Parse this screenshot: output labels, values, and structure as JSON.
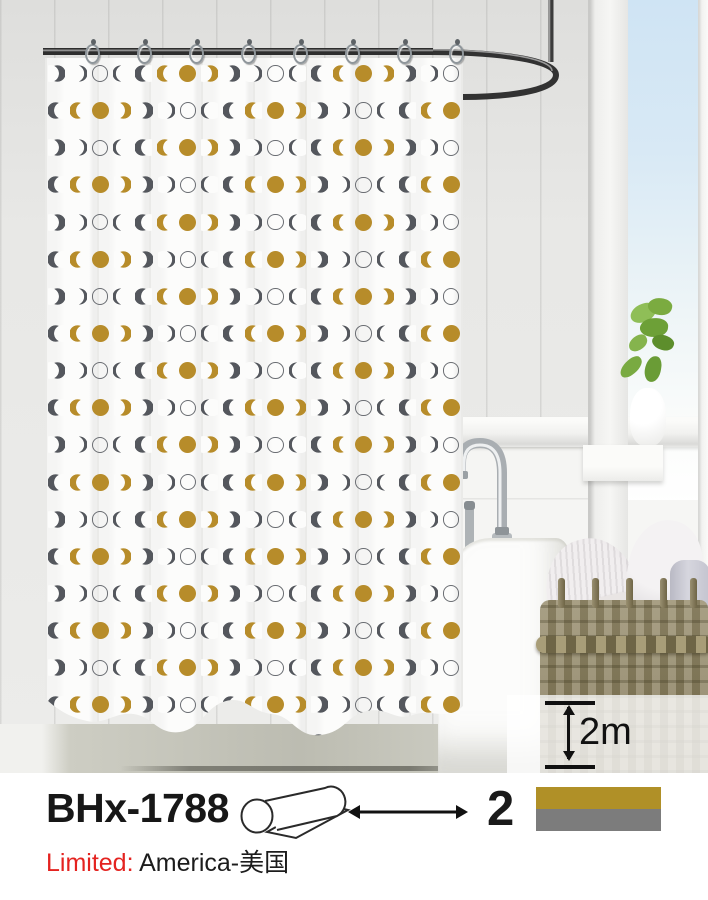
{
  "product": {
    "model": "BHx-1788",
    "color_count": "2",
    "height_label": "2m",
    "limited_label": "Limited:",
    "limited_value": "America-美国",
    "swatches": [
      {
        "name": "gold",
        "hex": "#b09027"
      },
      {
        "name": "gray",
        "hex": "#7c7c7c"
      }
    ]
  },
  "pattern": {
    "motif": "moon-phases",
    "gold": "#b78c2a",
    "gray": "#54575d",
    "ring_color": "#6b6e73",
    "sequence": [
      "gold-open",
      "gold-full",
      "gold-close",
      "gray-bold-close",
      "gray-thin-close",
      "ring",
      "gray-thin-open",
      "gray-bold-open"
    ],
    "rows": 19,
    "cols": 19,
    "row_offsets": [
      3,
      7
    ]
  },
  "scene": {
    "hook_count": 8,
    "sky_color": "#cfe4f4",
    "wall_color": "#e6e6e4",
    "curtain_color": "#fcfcfb",
    "rail_color": "#343434",
    "basket_color": "#948a66"
  }
}
